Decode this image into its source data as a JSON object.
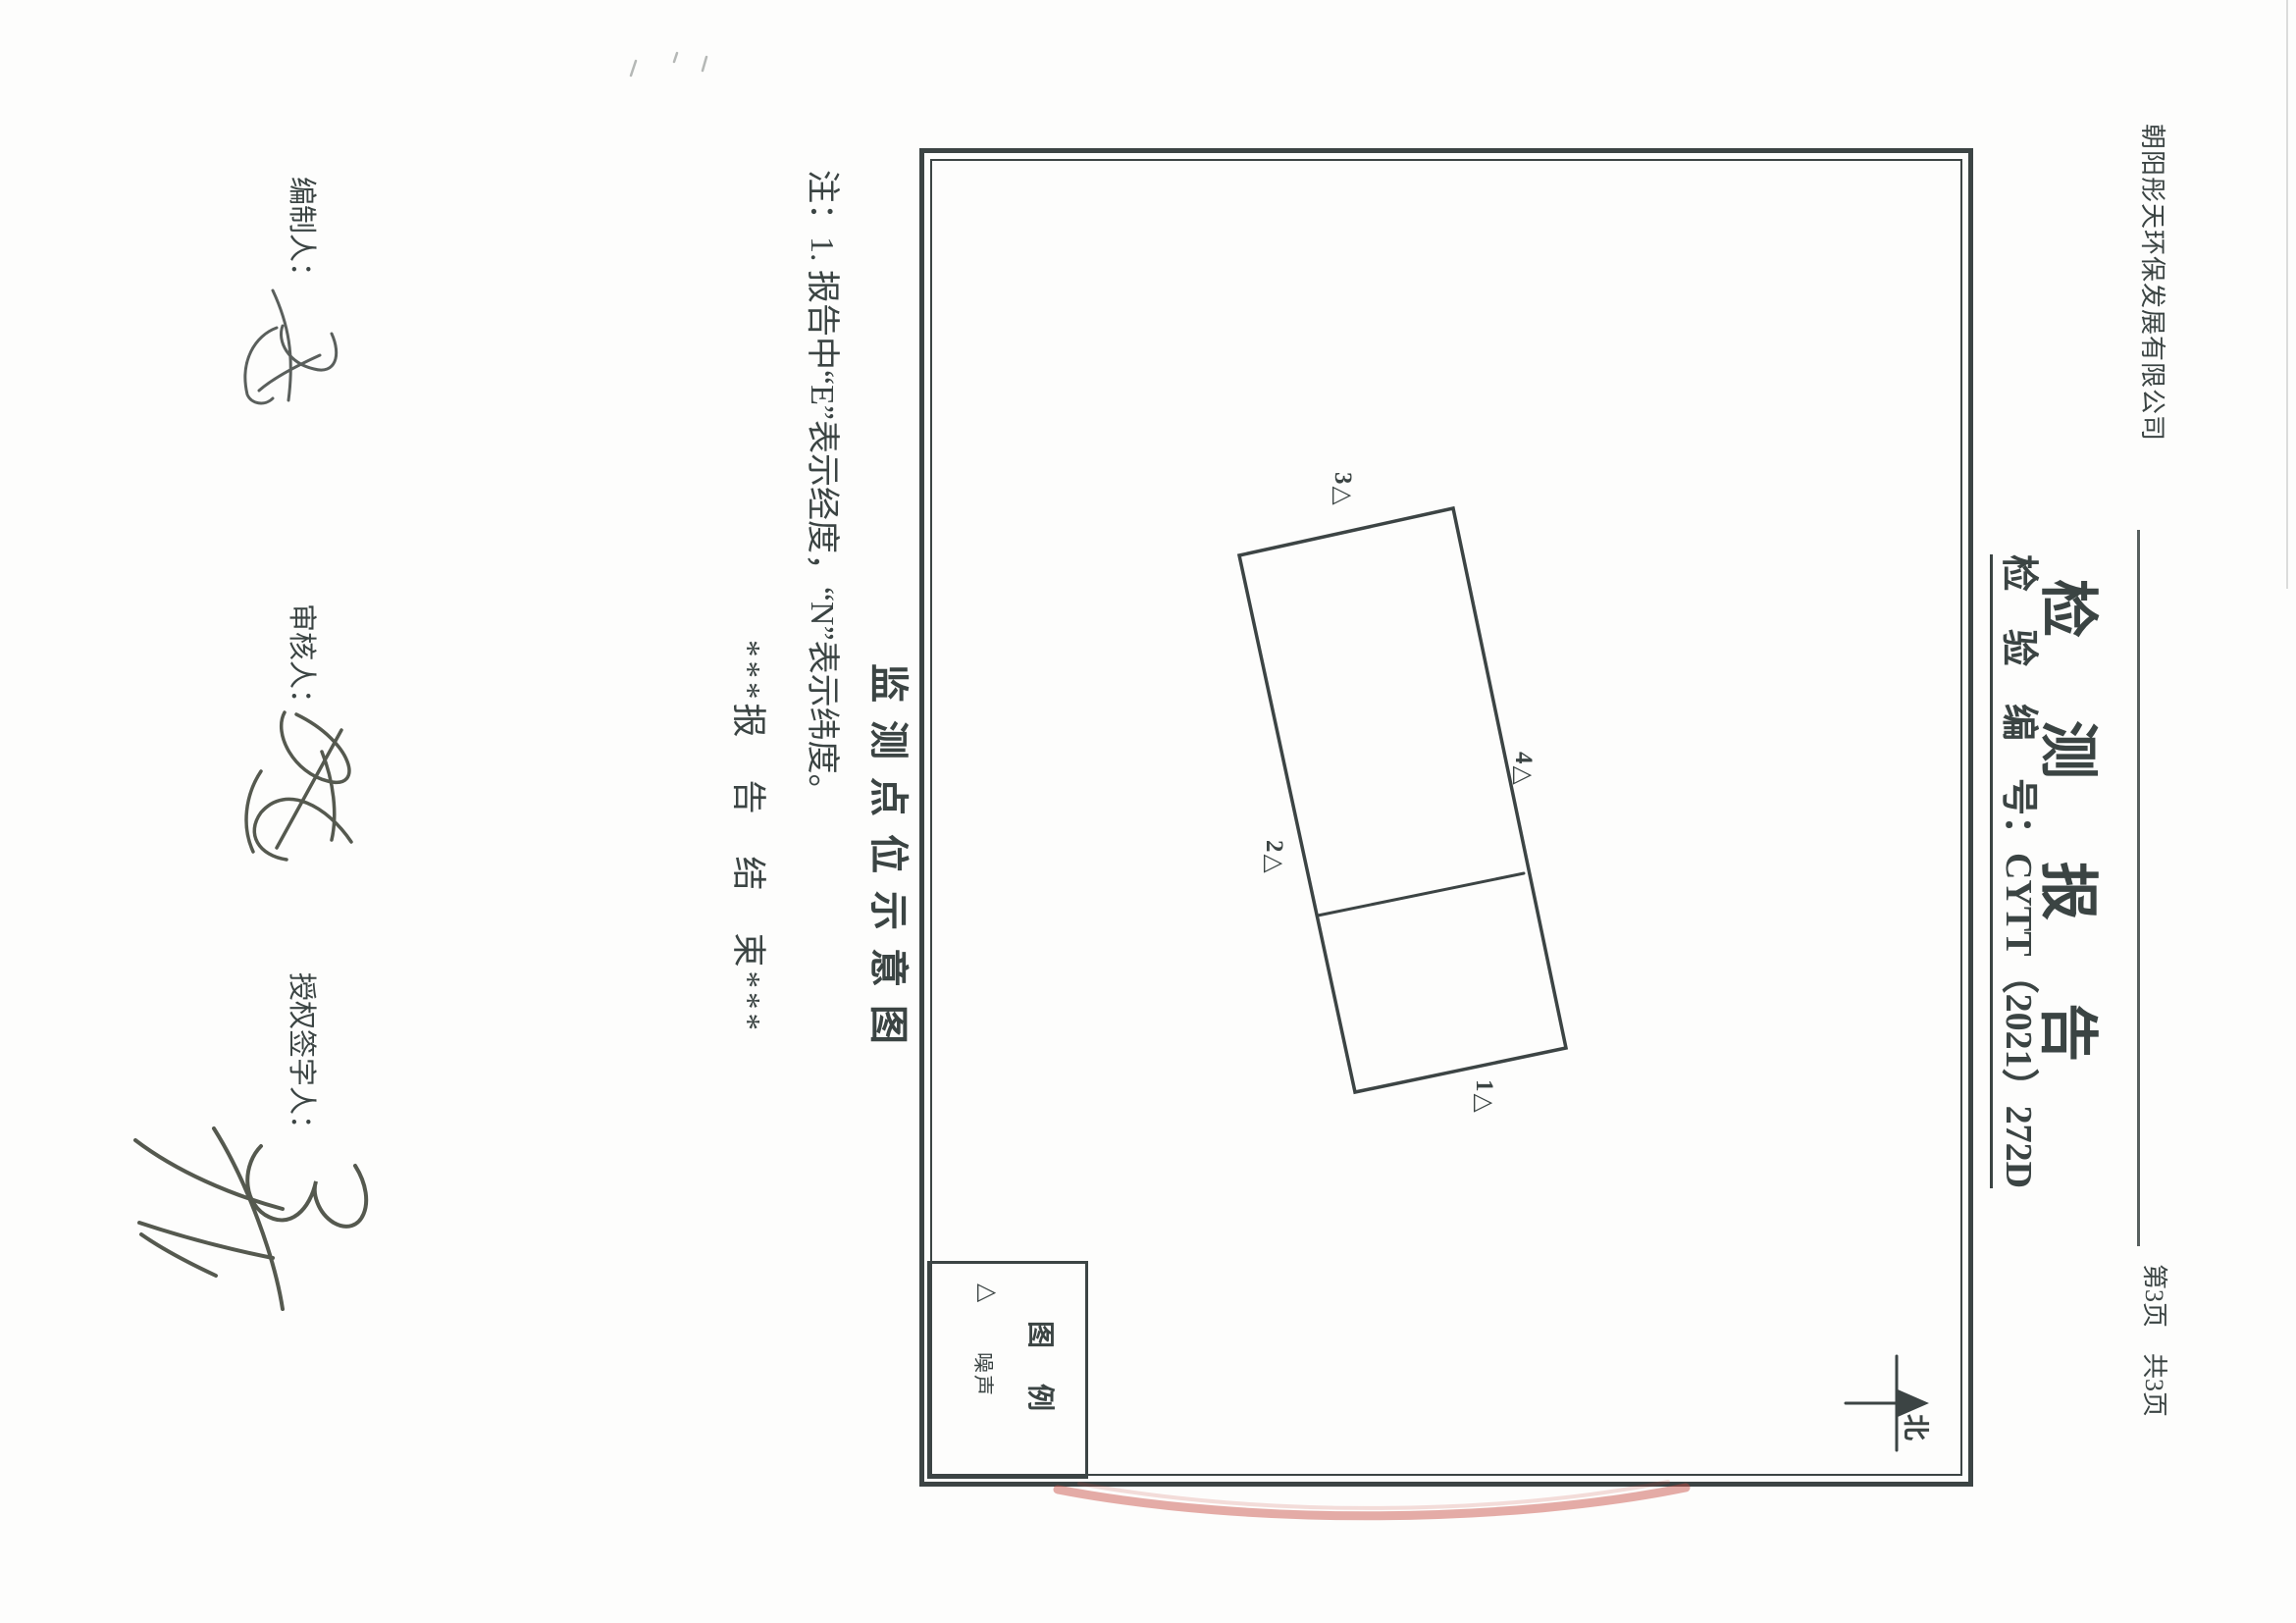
{
  "header": {
    "company": "朝阳彤天环保发展有限公司",
    "page_indicator": "第3页　共3页"
  },
  "title": "检测报告",
  "report_no": "检　验　编　号：CYTT（2021）272D",
  "map": {
    "points": [
      {
        "id": "1",
        "label": "1△"
      },
      {
        "id": "2",
        "label": "2△"
      },
      {
        "id": "3",
        "label": "3△"
      },
      {
        "id": "4",
        "label": "4△"
      }
    ],
    "legend": {
      "title": "图　例",
      "item_symbol": "△",
      "item_label": "噪声"
    },
    "north_label": "北"
  },
  "caption": "监测点位示意图",
  "note": "注：1. 报告中“E”表示经度，“N”表示纬度。",
  "end_marker": "***报　告　结　束***",
  "signatures": [
    {
      "role": "编制人："
    },
    {
      "role": "审核人："
    },
    {
      "role": "授权签字人："
    }
  ],
  "colors": {
    "ink": "#3b4443",
    "stamp_red": "#c5473f",
    "paper": "#fdfdfc"
  }
}
